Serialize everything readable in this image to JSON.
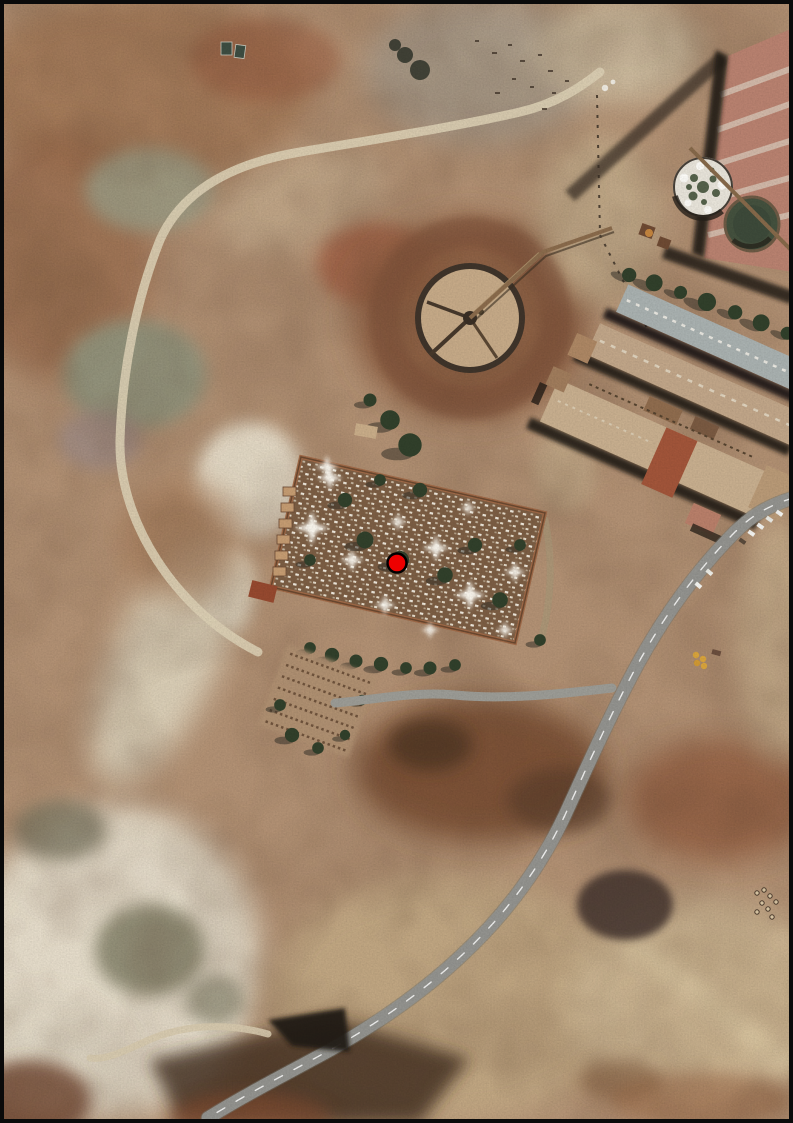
{
  "app": {
    "type": "aerial-imagery-view",
    "description": "Orthophoto of an arid mining-industrial area: walled cemetery with white tombs and cypress trees at center-left, circular thickener tank at center, industrial warehouses and two clarifier tanks at top right, curving paved road crossing the lower right, pale tailings ground at bottom left. A single red point marker is placed inside the cemetery. No text labels are visible.",
    "text_labels": []
  },
  "map": {
    "frame_color": "#0a0a0a",
    "marker": {
      "name": "location-marker",
      "shape": "circle",
      "fill": "#ee0000",
      "stroke": "#000000",
      "x_px": 397,
      "y_px": 563,
      "radius_px": 9.5
    },
    "imagery": {
      "dominant_colors": [
        "#b29174",
        "#8a5c41",
        "#e8e1cf",
        "#c2a984",
        "#93938f"
      ],
      "features": [
        {
          "name": "cemetery-compound",
          "color": "#7c5e44",
          "detail": "walled enclosure with white grave markers and dark trees"
        },
        {
          "name": "central-thickener-tank",
          "color": "#c6aa88"
        },
        {
          "name": "white-clarifier-tank",
          "color": "#e8e4da"
        },
        {
          "name": "dark-water-tank",
          "color": "#44513e"
        },
        {
          "name": "industrial-warehouses",
          "color": "#c1a689"
        },
        {
          "name": "big-red-roof-building",
          "color": "#b98270"
        },
        {
          "name": "main-road",
          "color": "#93938f"
        },
        {
          "name": "access-road",
          "color": "#9c9c96"
        },
        {
          "name": "dirt-track",
          "color": "#dbcfb4"
        },
        {
          "name": "tailings-pale-ground",
          "color": "#e8e1cf"
        },
        {
          "name": "parking-lot",
          "color": "#b09172"
        },
        {
          "name": "yellow-machinery",
          "color": "#d9a43c"
        }
      ]
    }
  }
}
